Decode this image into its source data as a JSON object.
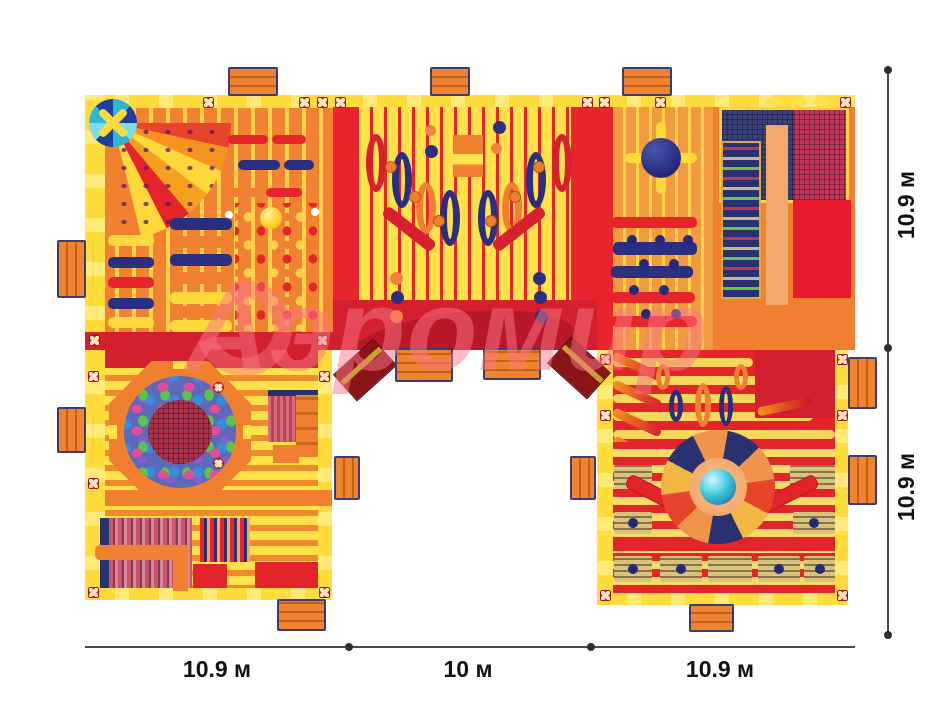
{
  "watermark": {
    "text": "Аэромир"
  },
  "dimensions": {
    "right": [
      {
        "label": "10.9 м"
      },
      {
        "label": "10.9 м"
      }
    ],
    "bottom": [
      {
        "label": "10.9 м"
      },
      {
        "label": "10 м"
      },
      {
        "label": "10.9 м"
      }
    ]
  },
  "colors": {
    "wall_yellow": "#ffdc3c",
    "slat_yellow": "#ffe14a",
    "orange": "#f08030",
    "red": "#e3242b",
    "dark_red": "#d41f2e",
    "navy": "#2a2f80",
    "teal": "#3ec8dc",
    "salmon": "#f2a96e",
    "dimension_line": "#4a4a4a",
    "watermark_pink": "rgba(250,118,134,0.5)"
  }
}
